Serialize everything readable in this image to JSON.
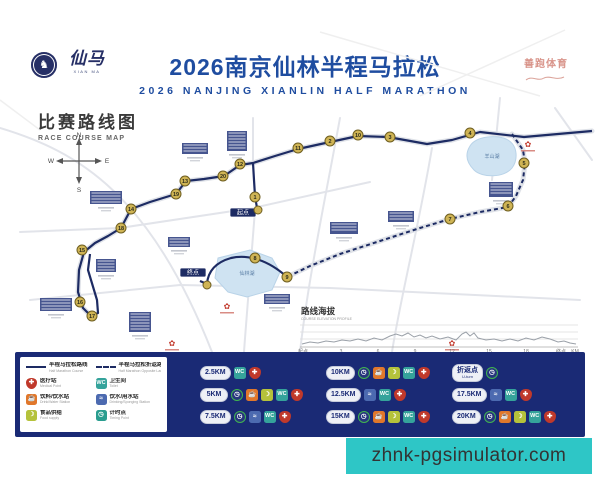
{
  "header": {
    "badge_icon": "xianma-circle-badge",
    "logo_zh": "仙马",
    "logo_en": "XIAN MA",
    "title_zh": "2026南京仙林半程马拉松",
    "title_en": "2026 NANJING XIANLIN HALF MARATHON",
    "stamp_zh": "善跑体育",
    "title_color": "#1f4da0"
  },
  "map": {
    "section_title_zh": "比赛路线图",
    "section_title_en": "RACE COURSE MAP",
    "compass": {
      "n": "N",
      "e": "E",
      "s": "S",
      "w": "W"
    },
    "start_label": "起点",
    "finish_label": "终点",
    "lake_center_label": "仙林湖",
    "lake_ne_label": "羊山湖",
    "marker_fill": "#cfb455",
    "route_color": "#1d2b63",
    "markers": [
      {
        "n": "1",
        "x": 255,
        "y": 197
      },
      {
        "n": "2",
        "x": 330,
        "y": 141
      },
      {
        "n": "3",
        "x": 390,
        "y": 137
      },
      {
        "n": "4",
        "x": 470,
        "y": 133
      },
      {
        "n": "5",
        "x": 524,
        "y": 163
      },
      {
        "n": "6",
        "x": 508,
        "y": 206
      },
      {
        "n": "7",
        "x": 450,
        "y": 219
      },
      {
        "n": "8",
        "x": 255,
        "y": 258
      },
      {
        "n": "9",
        "x": 287,
        "y": 277
      },
      {
        "n": "10",
        "x": 358,
        "y": 135
      },
      {
        "n": "11",
        "x": 298,
        "y": 148
      },
      {
        "n": "12",
        "x": 240,
        "y": 164
      },
      {
        "n": "13",
        "x": 185,
        "y": 181
      },
      {
        "n": "14",
        "x": 131,
        "y": 209
      },
      {
        "n": "15",
        "x": 82,
        "y": 250
      },
      {
        "n": "16",
        "x": 80,
        "y": 302
      },
      {
        "n": "17",
        "x": 92,
        "y": 316
      },
      {
        "n": "18",
        "x": 121,
        "y": 228
      },
      {
        "n": "19",
        "x": 176,
        "y": 194
      },
      {
        "n": "20",
        "x": 223,
        "y": 176
      }
    ]
  },
  "elevation": {
    "title_zh": "路线海拔",
    "title_en": "COURSE ELEVATION PROFILE",
    "x_labels": [
      "起点",
      "3",
      "6",
      "9",
      "12",
      "15",
      "18",
      "终点"
    ],
    "unit": "KM"
  },
  "chart_data": {
    "type": "line",
    "title": "路线海拔 COURSE ELEVATION PROFILE",
    "x": [
      "起点",
      "3",
      "6",
      "9",
      "12",
      "15",
      "18",
      "终点"
    ],
    "xlabel": "KM",
    "values_estimated": true,
    "values": [
      14,
      15,
      14,
      17,
      15,
      16,
      17,
      13
    ],
    "note": "mostly flat profile with small undulations"
  },
  "legend": {
    "items": [
      {
        "icon": "line-solid",
        "zh": "半程马拉松路线",
        "en": "Half Marathon Course"
      },
      {
        "icon": "line-dashed",
        "zh": "半程马拉松折返路线",
        "en": "Half Marathon Opposite Lane"
      },
      {
        "icon": "medical",
        "zh": "医疗站",
        "en": "Medical Point"
      },
      {
        "icon": "wc",
        "zh": "卫生间",
        "en": "Toilet"
      },
      {
        "icon": "drink",
        "zh": "饮料/饮水站",
        "en": "Drink/Water Station"
      },
      {
        "icon": "sponge",
        "zh": "饮水/用水站",
        "en": "Drinking/Sponging Station"
      },
      {
        "icon": "food",
        "zh": "食品供给",
        "en": "Food supply"
      },
      {
        "icon": "timer",
        "zh": "计时点",
        "en": "Timing Point"
      }
    ],
    "km_rows": [
      {
        "label": "2.5KM",
        "icons": [
          "wc",
          "medical"
        ]
      },
      {
        "label": "5KM",
        "icons": [
          "timer",
          "drink",
          "food",
          "wc",
          "medical"
        ]
      },
      {
        "label": "7.5KM",
        "icons": [
          "timer",
          "sponge",
          "wc",
          "medical"
        ]
      },
      {
        "label": "10KM",
        "icons": [
          "timer",
          "drink",
          "food",
          "wc",
          "medical"
        ]
      },
      {
        "label": "12.5KM",
        "icons": [
          "sponge",
          "wc",
          "medical"
        ]
      },
      {
        "label": "15KM",
        "icons": [
          "timer",
          "drink",
          "food",
          "wc",
          "medical"
        ]
      },
      {
        "label": "折返点",
        "sub": "U-turn",
        "icons": [
          "timer"
        ]
      },
      {
        "label": "17.5KM",
        "icons": [
          "sponge",
          "wc",
          "medical"
        ]
      },
      {
        "label": "20KM",
        "icons": [
          "timer",
          "drink",
          "food",
          "wc",
          "medical"
        ]
      }
    ]
  },
  "icon_glyphs": {
    "wc": "WC",
    "medical": "✚",
    "drink": "☕",
    "food": "☽",
    "sponge": "≈",
    "timer": "◷"
  },
  "watermark": {
    "text": "zhnk-pgsimulator.com",
    "bg": "#2ec6c6"
  }
}
